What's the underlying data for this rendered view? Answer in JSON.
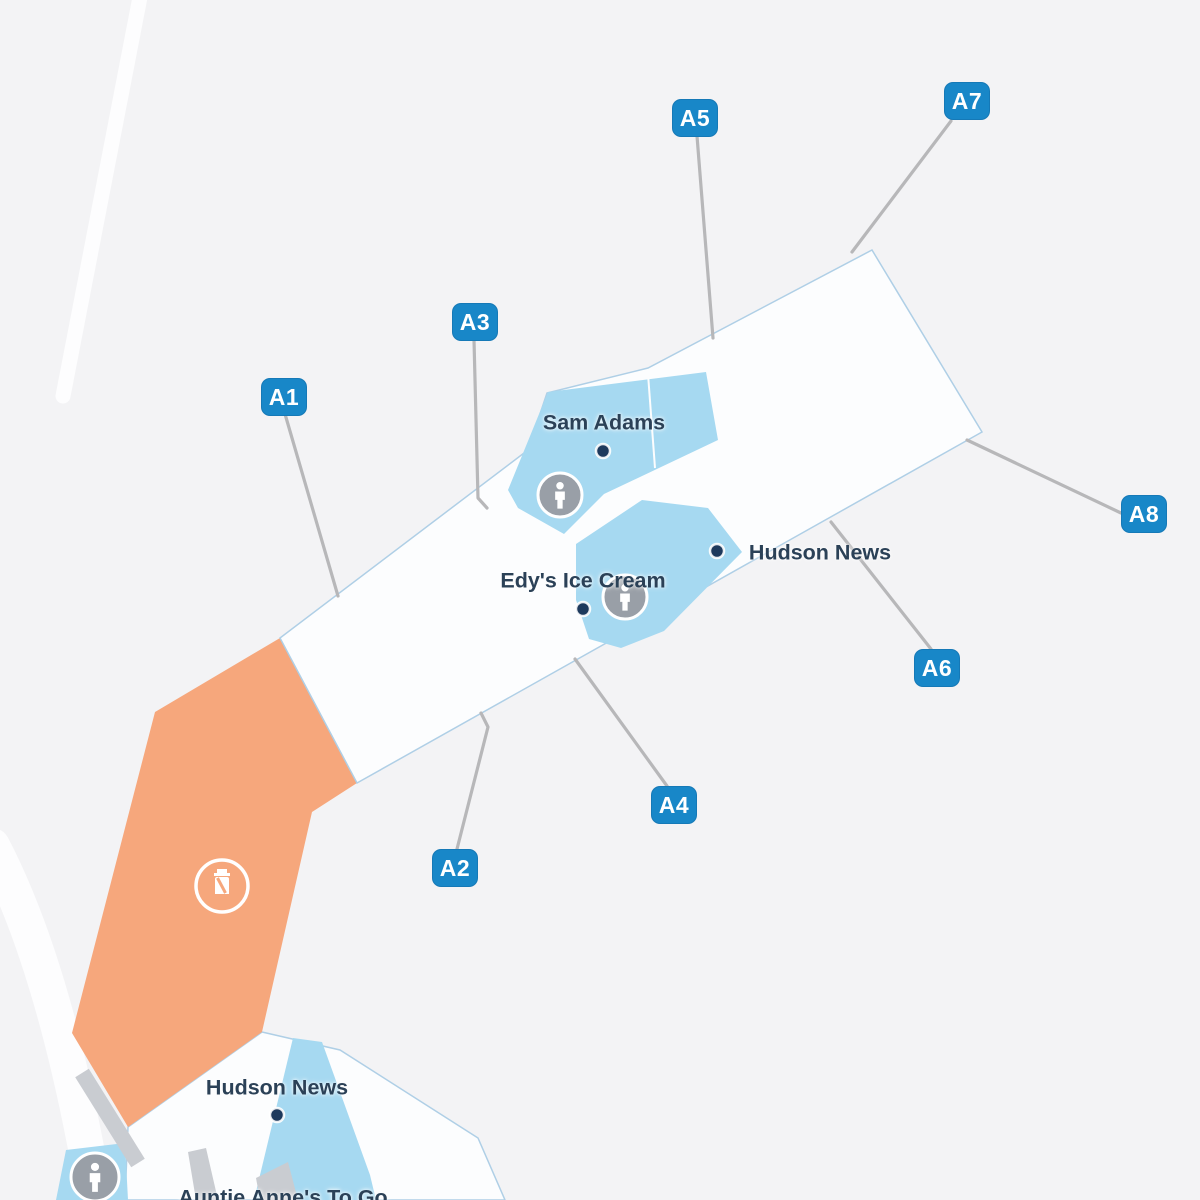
{
  "map": {
    "kind": "airport-concourse-map",
    "palette": {
      "background": "#f3f3f5",
      "terminal_fill": "#fcfdfe",
      "terminal_stroke": "#afcfe6",
      "shop_fill": "#a6d9f1",
      "security_zone_fill": "#f6a77c",
      "gate_badge_blue": "#1887c8",
      "label_navy": "#2b4157",
      "poi_dot_navy": "#1e3a5d",
      "leader_gray": "#b7b7b9",
      "walkway_gray": "#c9ccd1",
      "road_white": "#fdfdfe"
    },
    "gates": [
      {
        "label": "A1",
        "x": 261,
        "y": 378,
        "line": "285,414 338,596"
      },
      {
        "label": "A2",
        "x": 432,
        "y": 849,
        "line": "457,849 488,727 481,713"
      },
      {
        "label": "A3",
        "x": 452,
        "y": 303,
        "line": "474,340 478,498 487,508"
      },
      {
        "label": "A4",
        "x": 651,
        "y": 786,
        "line": "667,786 575,659"
      },
      {
        "label": "A5",
        "x": 672,
        "y": 99,
        "line": "697,136 713,338"
      },
      {
        "label": "A6",
        "x": 914,
        "y": 649,
        "line": "931,649 831,522"
      },
      {
        "label": "A7",
        "x": 944,
        "y": 82,
        "line": "951,121 852,252"
      },
      {
        "label": "A8",
        "x": 1121,
        "y": 495,
        "line": "1121,513 967,440"
      }
    ],
    "places": [
      {
        "id": "sam-adams",
        "label": "Sam Adams",
        "lx": 604,
        "ly": 423,
        "dot": [
          603,
          451
        ]
      },
      {
        "id": "edys-ice-cream",
        "label": "Edy's Ice Cream",
        "lx": 583,
        "ly": 581,
        "dot": [
          583,
          609
        ]
      },
      {
        "id": "hudson-news-concourse",
        "label": "Hudson News",
        "lx": 820,
        "ly": 553,
        "dot": [
          717,
          551
        ]
      },
      {
        "id": "hudson-news-terminal",
        "label": "Hudson News",
        "lx": 277,
        "ly": 1088,
        "dot": [
          277,
          1115
        ]
      },
      {
        "id": "auntie-annes-to-go",
        "label": "Auntie Anne's To Go",
        "lx": 283,
        "ly": 1198,
        "dot": null
      }
    ],
    "restrooms": [
      {
        "x": 560,
        "y": 495,
        "r": 22
      },
      {
        "x": 625,
        "y": 597,
        "r": 22
      },
      {
        "x": 95,
        "y": 1177,
        "r": 24
      }
    ],
    "security_checkpoint": {
      "x": 222,
      "y": 886,
      "r": 26
    }
  }
}
